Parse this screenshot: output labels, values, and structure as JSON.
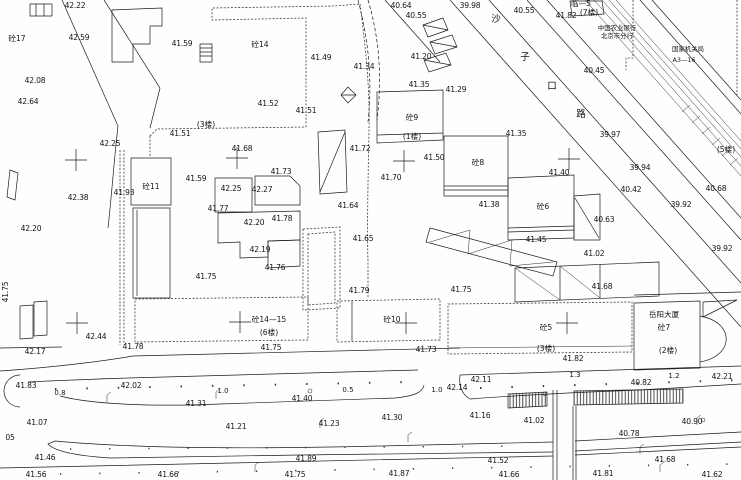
{
  "meta": {
    "type": "cad-topographic-survey-map",
    "background_color": "#fefefe",
    "line_color": "#1c1c1c"
  },
  "labels": {
    "elevations": [
      {
        "x": 75,
        "y": 8,
        "t": "42.22"
      },
      {
        "x": 79,
        "y": 40,
        "t": "42.59"
      },
      {
        "x": 35,
        "y": 83,
        "t": "42.08"
      },
      {
        "x": 28,
        "y": 104,
        "t": "42.64"
      },
      {
        "x": 182,
        "y": 46,
        "t": "41.59"
      },
      {
        "x": 321,
        "y": 60,
        "t": "41.49"
      },
      {
        "x": 268,
        "y": 106,
        "t": "41.52"
      },
      {
        "x": 306,
        "y": 113,
        "t": "41.51"
      },
      {
        "x": 180,
        "y": 136,
        "t": "41.51"
      },
      {
        "x": 110,
        "y": 146,
        "t": "42.25"
      },
      {
        "x": 78,
        "y": 200,
        "t": "42.38"
      },
      {
        "x": 31,
        "y": 231,
        "t": "42.20"
      },
      {
        "x": 124,
        "y": 195,
        "t": "41.93"
      },
      {
        "x": 196,
        "y": 181,
        "t": "41.59"
      },
      {
        "x": 231,
        "y": 191,
        "t": "42.25"
      },
      {
        "x": 262,
        "y": 192,
        "t": "42.27"
      },
      {
        "x": 242,
        "y": 151,
        "t": "41.68"
      },
      {
        "x": 281,
        "y": 174,
        "t": "41.73"
      },
      {
        "x": 218,
        "y": 211,
        "t": "41.77"
      },
      {
        "x": 254,
        "y": 225,
        "t": "42.20"
      },
      {
        "x": 282,
        "y": 221,
        "t": "41.78"
      },
      {
        "x": 260,
        "y": 252,
        "t": "42.19"
      },
      {
        "x": 275,
        "y": 270,
        "t": "41.76"
      },
      {
        "x": 206,
        "y": 279,
        "t": "41.75"
      },
      {
        "x": 271,
        "y": 350,
        "t": "41.75"
      },
      {
        "x": 401,
        "y": 8,
        "t": "40.64"
      },
      {
        "x": 416,
        "y": 18,
        "t": "40.55"
      },
      {
        "x": 470,
        "y": 8,
        "t": "39.98"
      },
      {
        "x": 524,
        "y": 13,
        "t": "40.55"
      },
      {
        "x": 566,
        "y": 18,
        "t": "41.82"
      },
      {
        "x": 364,
        "y": 69,
        "t": "41.34"
      },
      {
        "x": 421,
        "y": 59,
        "t": "41.20"
      },
      {
        "x": 419,
        "y": 87,
        "t": "41.35"
      },
      {
        "x": 456,
        "y": 92,
        "t": "41.29"
      },
      {
        "x": 516,
        "y": 136,
        "t": "41.35"
      },
      {
        "x": 360,
        "y": 151,
        "t": "41.72"
      },
      {
        "x": 434,
        "y": 160,
        "t": "41.50"
      },
      {
        "x": 391,
        "y": 180,
        "t": "41.70"
      },
      {
        "x": 348,
        "y": 208,
        "t": "41.64"
      },
      {
        "x": 363,
        "y": 241,
        "t": "41.65"
      },
      {
        "x": 359,
        "y": 293,
        "t": "41.79"
      },
      {
        "x": 461,
        "y": 292,
        "t": "41.75"
      },
      {
        "x": 489,
        "y": 207,
        "t": "41.38"
      },
      {
        "x": 559,
        "y": 175,
        "t": "41.40"
      },
      {
        "x": 536,
        "y": 242,
        "t": "41.45"
      },
      {
        "x": 594,
        "y": 73,
        "t": "40.45"
      },
      {
        "x": 610,
        "y": 137,
        "t": "39.97"
      },
      {
        "x": 640,
        "y": 170,
        "t": "39.94"
      },
      {
        "x": 631,
        "y": 192,
        "t": "40.42"
      },
      {
        "x": 681,
        "y": 207,
        "t": "39.92"
      },
      {
        "x": 716,
        "y": 191,
        "t": "40.68"
      },
      {
        "x": 604,
        "y": 222,
        "t": "40.63"
      },
      {
        "x": 722,
        "y": 251,
        "t": "39.92"
      },
      {
        "x": 594,
        "y": 256,
        "t": "41.02"
      },
      {
        "x": 602,
        "y": 289,
        "t": "41.68"
      },
      {
        "x": 426,
        "y": 352,
        "t": "41.73"
      },
      {
        "x": 573,
        "y": 361,
        "t": "41.82"
      },
      {
        "x": 96,
        "y": 339,
        "t": "42.44"
      },
      {
        "x": 35,
        "y": 354,
        "t": "42.17"
      },
      {
        "x": 133,
        "y": 349,
        "t": "41.78"
      },
      {
        "x": 26,
        "y": 388,
        "t": "41.83"
      },
      {
        "x": 131,
        "y": 388,
        "t": "42.02"
      },
      {
        "x": 196,
        "y": 406,
        "t": "41.31"
      },
      {
        "x": 37,
        "y": 425,
        "t": "41.07"
      },
      {
        "x": 236,
        "y": 429,
        "t": "41.21"
      },
      {
        "x": 45,
        "y": 460,
        "t": "41.46"
      },
      {
        "x": 36,
        "y": 477,
        "t": "41.56"
      },
      {
        "x": 168,
        "y": 477,
        "t": "41.66"
      },
      {
        "x": 302,
        "y": 401,
        "t": "41.40"
      },
      {
        "x": 457,
        "y": 390,
        "t": "42.14"
      },
      {
        "x": 481,
        "y": 382,
        "t": "42.11"
      },
      {
        "x": 392,
        "y": 420,
        "t": "41.30"
      },
      {
        "x": 480,
        "y": 418,
        "t": "41.16"
      },
      {
        "x": 329,
        "y": 426,
        "t": "41.23"
      },
      {
        "x": 306,
        "y": 461,
        "t": "41.89"
      },
      {
        "x": 295,
        "y": 477,
        "t": "41.75"
      },
      {
        "x": 399,
        "y": 476,
        "t": "41.87"
      },
      {
        "x": 641,
        "y": 385,
        "t": "40.82"
      },
      {
        "x": 722,
        "y": 379,
        "t": "42.21"
      },
      {
        "x": 534,
        "y": 423,
        "t": "41.02"
      },
      {
        "x": 692,
        "y": 424,
        "t": "40.90"
      },
      {
        "x": 629,
        "y": 436,
        "t": "40.78"
      },
      {
        "x": 498,
        "y": 463,
        "t": "41.52"
      },
      {
        "x": 665,
        "y": 462,
        "t": "41.68"
      },
      {
        "x": 603,
        "y": 476,
        "t": "41.81"
      },
      {
        "x": 712,
        "y": 477,
        "t": "41.62"
      },
      {
        "x": 509,
        "y": 477,
        "t": "41.66"
      },
      {
        "x": 10,
        "y": 440,
        "t": "05"
      }
    ],
    "distances": [
      {
        "x": 60,
        "y": 395,
        "t": "0.8"
      },
      {
        "x": 223,
        "y": 393,
        "t": "1.0"
      },
      {
        "x": 348,
        "y": 392,
        "t": "0.5"
      },
      {
        "x": 437,
        "y": 392,
        "t": "1.0"
      },
      {
        "x": 575,
        "y": 377,
        "t": "1.3"
      },
      {
        "x": 674,
        "y": 378,
        "t": "1.2"
      }
    ],
    "buildings": [
      {
        "x": 17,
        "y": 41,
        "t": "砼17"
      },
      {
        "x": 260,
        "y": 47,
        "t": "砼14"
      },
      {
        "x": 151,
        "y": 189,
        "t": "砼11"
      },
      {
        "x": 412,
        "y": 120,
        "t": "砼9"
      },
      {
        "x": 412,
        "y": 139,
        "t": "(1楼)"
      },
      {
        "x": 206,
        "y": 127,
        "t": "(3楼)"
      },
      {
        "x": 478,
        "y": 165,
        "t": "砼8"
      },
      {
        "x": 543,
        "y": 209,
        "t": "砼6"
      },
      {
        "x": 269,
        "y": 322,
        "t": "砼14—15"
      },
      {
        "x": 269,
        "y": 335,
        "t": "(6楼)"
      },
      {
        "x": 392,
        "y": 322,
        "t": "砼10"
      },
      {
        "x": 546,
        "y": 330,
        "t": "砼5"
      },
      {
        "x": 546,
        "y": 351,
        "t": "(3楼)"
      },
      {
        "x": 664,
        "y": 317,
        "t": "岳阳大厦"
      },
      {
        "x": 664,
        "y": 330,
        "t": "砼7"
      },
      {
        "x": 668,
        "y": 353,
        "t": "(2楼)"
      },
      {
        "x": 581,
        "y": 6,
        "t": "临—5"
      },
      {
        "x": 589,
        "y": 15,
        "t": "(7楼)"
      },
      {
        "x": 726,
        "y": 152,
        "t": "(5楼)"
      }
    ],
    "places": [
      {
        "x": 617,
        "y": 30,
        "t": "中国农业银行"
      },
      {
        "x": 617,
        "y": 38,
        "t": "北京市分行"
      },
      {
        "x": 688,
        "y": 51,
        "t": "国家机关局"
      },
      {
        "x": 684,
        "y": 62,
        "t": "A3—16"
      }
    ],
    "road_chars": [
      {
        "x": 496,
        "y": 22,
        "t": "沙"
      },
      {
        "x": 525,
        "y": 60,
        "t": "子"
      },
      {
        "x": 552,
        "y": 89,
        "t": "口"
      },
      {
        "x": 581,
        "y": 117,
        "t": "路"
      }
    ],
    "rotated": [
      {
        "x": 8,
        "y": 292,
        "t": "41.75",
        "r": -90
      }
    ]
  }
}
